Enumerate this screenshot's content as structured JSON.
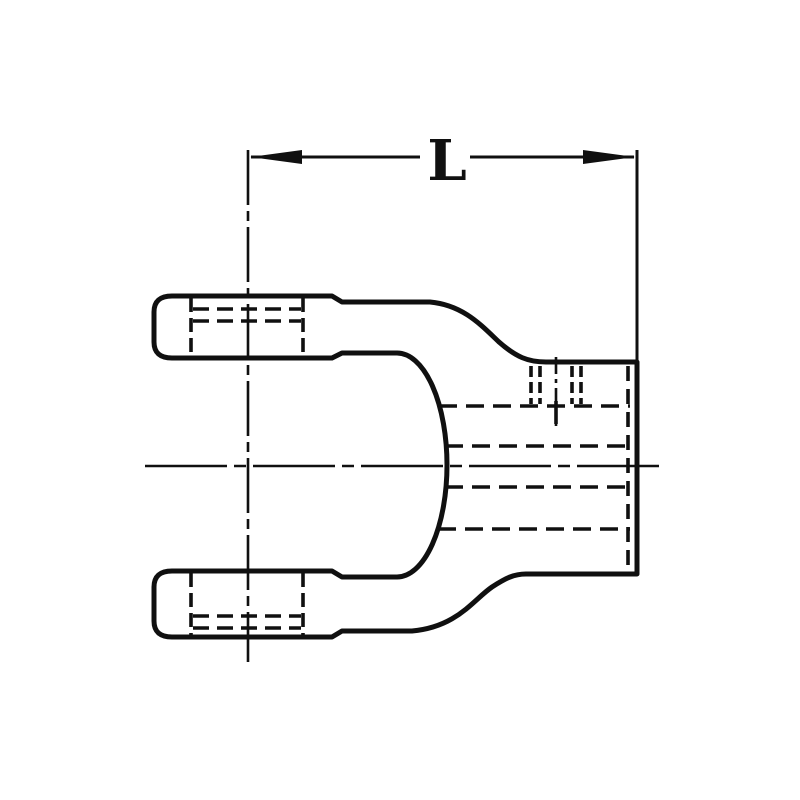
{
  "diagram": {
    "dimension_label": "L",
    "colors": {
      "line": "#101010",
      "background": "#ffffff"
    },
    "parts": {
      "drawing": "yoke-side-view-technical-drawing",
      "dimension": "overall-length-L"
    }
  }
}
